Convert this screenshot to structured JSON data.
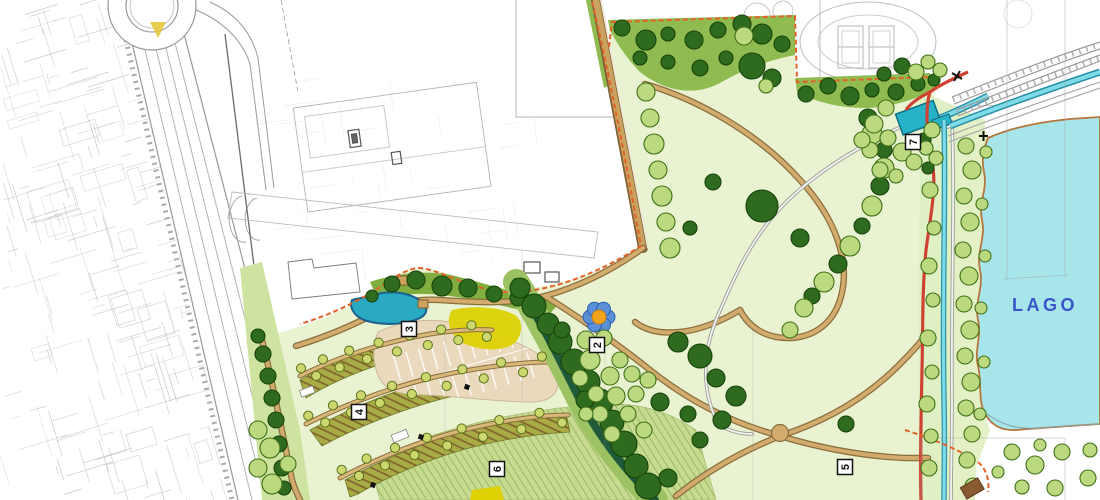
{
  "map": {
    "type": "landscape-master-plan",
    "lake_label": "LAGO",
    "markers": [
      {
        "id": "marker-2",
        "label": "2"
      },
      {
        "id": "marker-3",
        "label": "3"
      },
      {
        "id": "marker-4",
        "label": "4"
      },
      {
        "id": "marker-5",
        "label": "5"
      },
      {
        "id": "marker-6",
        "label": "6"
      },
      {
        "id": "marker-7",
        "label": "7"
      }
    ],
    "colors": {
      "lake": "#a6e6eb",
      "lake_label_blue": "#3a55c8",
      "lawn_light": "#e9f2d1",
      "lawn_hatched": "#c6db90",
      "green_band": "#8fbb50",
      "tree_dark": "#2e6b1e",
      "tree_light": "#bdd980",
      "path_tan": "#d2ab6d",
      "path_edge": "#8a6f3e",
      "route_red": "#cf4232",
      "boundary_orange": "#e2622a",
      "stream_cyan": "#54c6d8",
      "pool_teal": "#28b2c8",
      "pond_teal": "#2aa9c2",
      "orchard_olive": "#a9ab45",
      "parking_beige": "#ead9bd",
      "feature_yellow": "#ddd104",
      "sketch_gray": "#9a9a9a"
    }
  }
}
